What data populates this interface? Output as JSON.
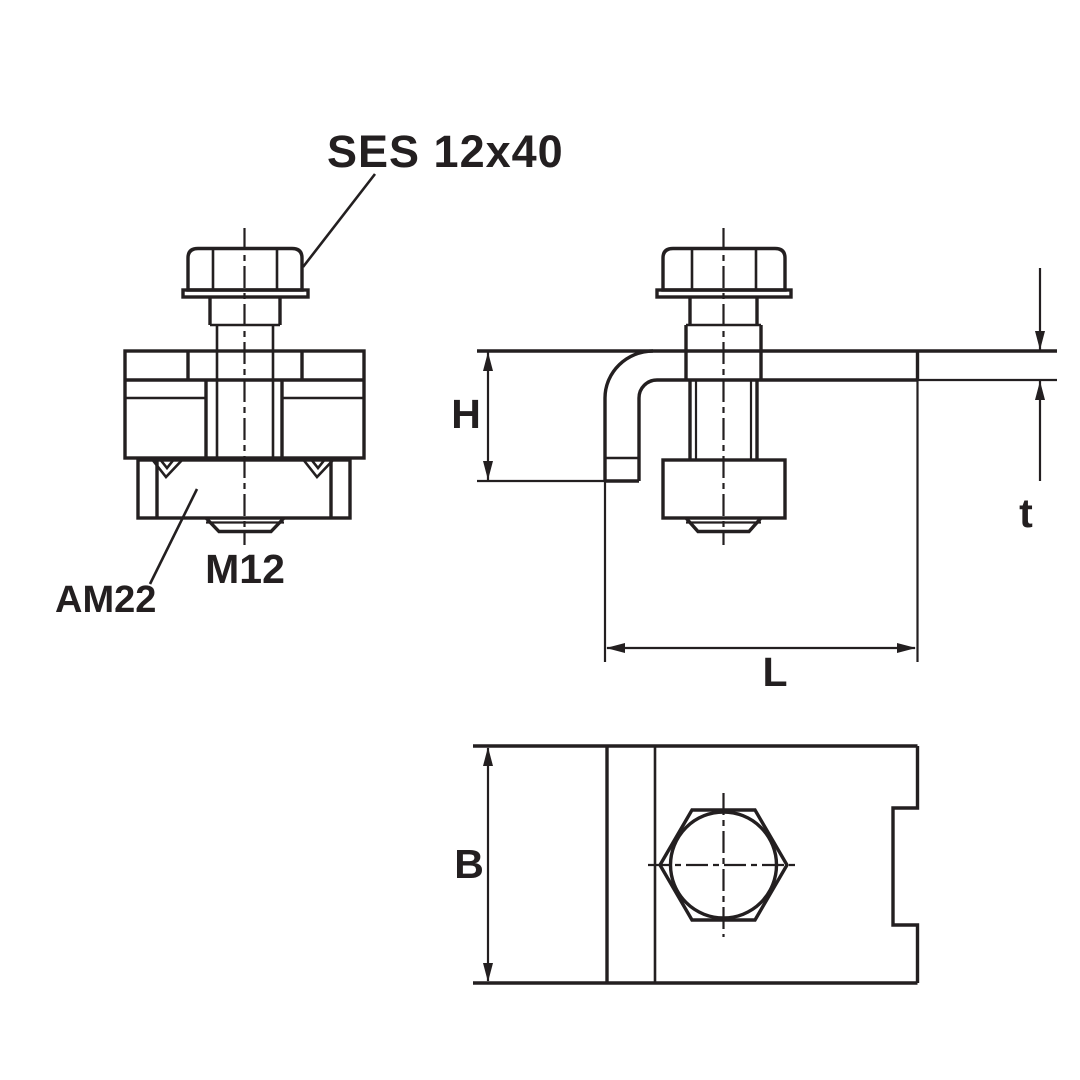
{
  "drawing": {
    "background_color": "#ffffff",
    "line_color": "#231f20",
    "type": "technical-drawing-beam-clamp"
  },
  "annotations": {
    "bolt_label": "SES 12x40",
    "nut_label": "AM22",
    "thread_label": "M12"
  },
  "dimensions": {
    "height_label": "H",
    "thickness_label": "t",
    "length_label": "L",
    "width_label": "B"
  }
}
